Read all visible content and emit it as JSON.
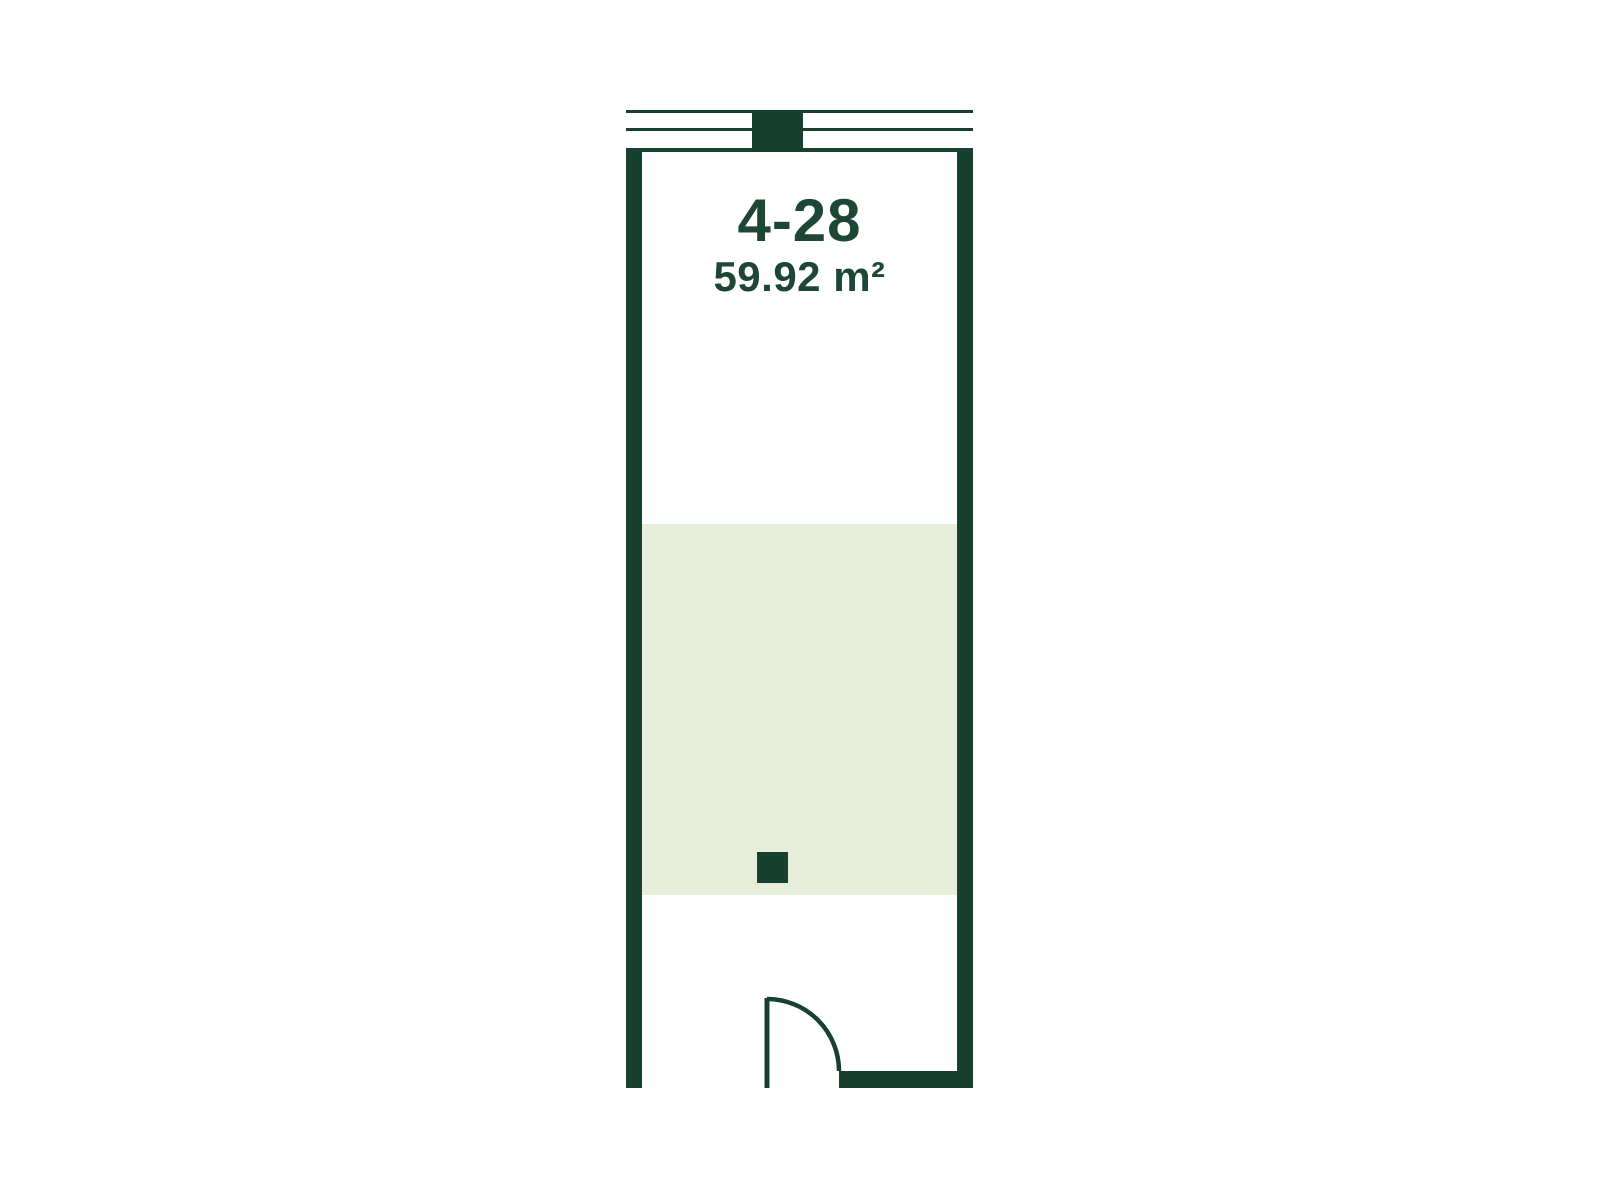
{
  "unit": {
    "number": "4-28",
    "area": "59.92 m²"
  },
  "colors": {
    "wall": "#17402E",
    "text": "#1D4634",
    "zone": "#E6EDD9",
    "background": "#FFFFFF"
  }
}
